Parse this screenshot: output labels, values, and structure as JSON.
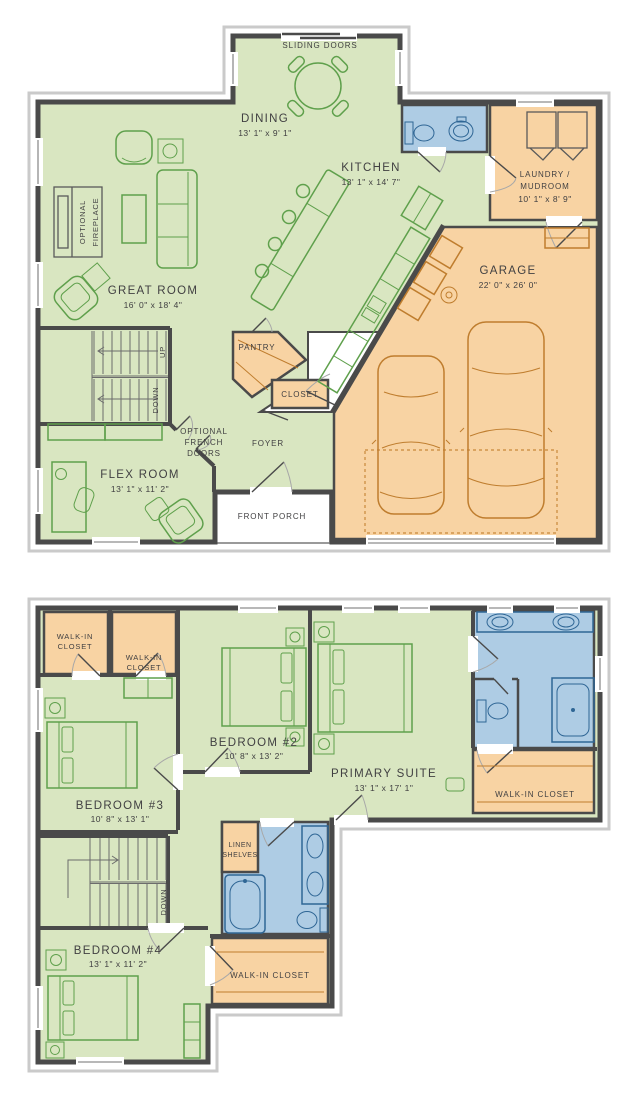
{
  "document": {
    "type": "two-story floor plan"
  },
  "colors": {
    "room_green": "#d9e6c1",
    "room_orange": "#f8d3a3",
    "room_blue": "#aecce4",
    "wall": "#4a4a4a",
    "furniture_green": "#5fa04c",
    "furniture_orange": "#bf7d2e",
    "fixture_blue": "#2f6695",
    "text": "#414042"
  },
  "floor1": {
    "sliding_doors": "SLIDING DOORS",
    "dining": {
      "name": "DINING",
      "dims": "13' 1\" x 9' 1\""
    },
    "kitchen": {
      "name": "KITCHEN",
      "dims": "13' 1\" x 14' 7\""
    },
    "laundry": {
      "line1": "LAUNDRY /",
      "line2": "MUDROOM",
      "dims": "10' 1\" x 8' 9\""
    },
    "garage": {
      "name": "GARAGE",
      "dims": "22' 0\" x 26' 0\""
    },
    "great_room": {
      "name": "GREAT ROOM",
      "dims": "16' 0\" x 18' 4\""
    },
    "flex": {
      "name": "FLEX ROOM",
      "dims": "13' 1\" x 11' 2\""
    },
    "fireplace": {
      "line1": "OPTIONAL",
      "line2": "FIREPLACE"
    },
    "french": {
      "line1": "OPTIONAL",
      "line2": "FRENCH",
      "line3": "DOORS"
    },
    "pantry": "PANTRY",
    "closet": "CLOSET",
    "foyer": "FOYER",
    "porch": "FRONT PORCH",
    "up": "UP",
    "down": "DOWN"
  },
  "floor2": {
    "wic_a": {
      "line1": "WALK-IN",
      "line2": "CLOSET"
    },
    "wic_b": {
      "line1": "WALK-IN",
      "line2": "CLOSET"
    },
    "bedroom2": {
      "name": "BEDROOM #2",
      "dims": "10' 8\" x 13' 2\""
    },
    "bedroom3": {
      "name": "BEDROOM #3",
      "dims": "10' 8\" x 13' 1\""
    },
    "bedroom4": {
      "name": "BEDROOM #4",
      "dims": "13' 1\" x 11' 2\""
    },
    "primary": {
      "name": "PRIMARY SUITE",
      "dims": "13' 1\" x 17' 1\""
    },
    "primary_wic": "WALK-IN CLOSET",
    "hall_wic": "WALK-IN CLO­SET",
    "linen": {
      "line1": "LINEN",
      "line2": "SHELVES"
    },
    "down": "DOWN"
  }
}
